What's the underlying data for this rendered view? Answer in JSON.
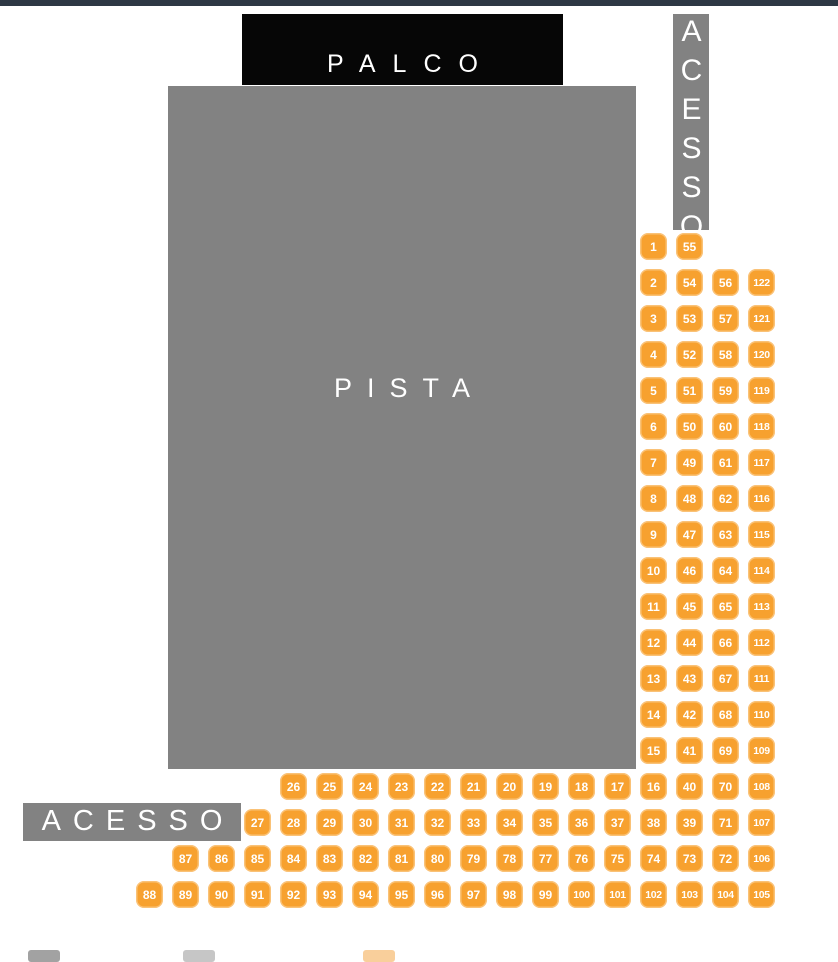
{
  "stage": {
    "label": "PALCO"
  },
  "floor": {
    "label": "PISTA"
  },
  "access_top_right": {
    "label": "ACESSO"
  },
  "access_bottom_left": {
    "label": "ACESSO"
  },
  "colors": {
    "top_bar": "#2D3844",
    "stage_black": "#060606",
    "zone_gray": "#828282",
    "seat_orange": "#F7A12F",
    "seat_text": "#FFFFFF"
  },
  "seat_map": {
    "right_block_rows": [
      [
        "1",
        "55"
      ],
      [
        "2",
        "54",
        "56",
        "122"
      ],
      [
        "3",
        "53",
        "57",
        "121"
      ],
      [
        "4",
        "52",
        "58",
        "120"
      ],
      [
        "5",
        "51",
        "59",
        "119"
      ],
      [
        "6",
        "50",
        "60",
        "118"
      ],
      [
        "7",
        "49",
        "61",
        "117"
      ],
      [
        "8",
        "48",
        "62",
        "116"
      ],
      [
        "9",
        "47",
        "63",
        "115"
      ],
      [
        "10",
        "46",
        "64",
        "114"
      ],
      [
        "11",
        "45",
        "65",
        "113"
      ],
      [
        "12",
        "44",
        "66",
        "112"
      ],
      [
        "13",
        "43",
        "67",
        "111"
      ],
      [
        "14",
        "42",
        "68",
        "110"
      ],
      [
        "15",
        "41",
        "69",
        "109"
      ]
    ],
    "bottom_rows": [
      [
        "26",
        "25",
        "24",
        "23",
        "22",
        "21",
        "20",
        "19",
        "18",
        "17",
        "16",
        "40",
        "70",
        "108"
      ],
      [
        "27",
        "28",
        "29",
        "30",
        "31",
        "32",
        "33",
        "34",
        "35",
        "36",
        "37",
        "38",
        "39",
        "71",
        "107"
      ],
      [
        "87",
        "86",
        "85",
        "84",
        "83",
        "82",
        "81",
        "80",
        "79",
        "78",
        "77",
        "76",
        "75",
        "74",
        "73",
        "72",
        "106"
      ],
      [
        "88",
        "89",
        "90",
        "91",
        "92",
        "93",
        "94",
        "95",
        "96",
        "97",
        "98",
        "99",
        "100",
        "101",
        "102",
        "103",
        "104",
        "105"
      ]
    ]
  },
  "legend": {
    "swatches": [
      {
        "name": "legend-swatch-gray",
        "color": "#A2A2A2"
      },
      {
        "name": "legend-swatch-light-gray",
        "color": "#C6C6C6"
      },
      {
        "name": "legend-swatch-light-orange",
        "color": "#F9CF9B"
      }
    ]
  }
}
